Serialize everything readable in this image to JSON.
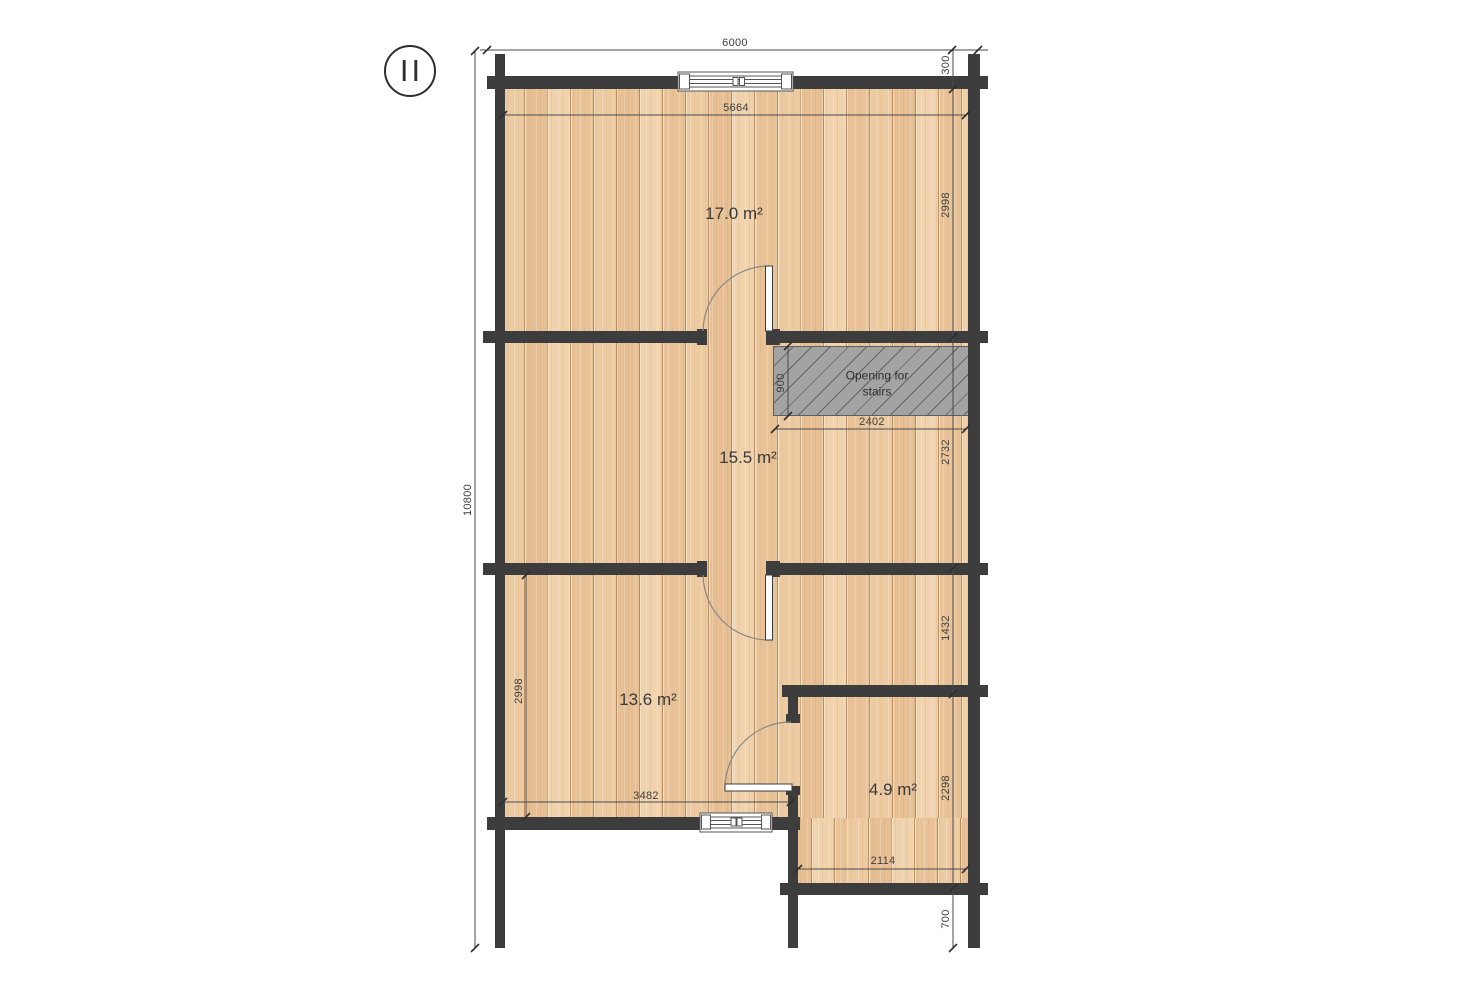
{
  "floor_marker": {
    "label": "II"
  },
  "rooms": {
    "room_17": {
      "area": "17.0 m²"
    },
    "room_15": {
      "area": "15.5 m²"
    },
    "room_13": {
      "area": "13.6 m²"
    },
    "room_4": {
      "area": "4.9 m²"
    }
  },
  "stairs_opening": {
    "line1": "Opening for",
    "line2": "stairs"
  },
  "dimensions": {
    "overall_width": "6000",
    "right_end_offset": "300",
    "top_inner_width": "5664",
    "upper_right_height": "2998",
    "stairs_height": "900",
    "stairs_width": "2402",
    "mid_right_height": "2732",
    "overall_height": "10800",
    "lower_right_height": "1432",
    "lower_left_height": "2998",
    "bottom_inner_width": "3482",
    "small_room_height": "2298",
    "small_room_width": "2114",
    "bottom_right_offset": "700"
  },
  "colors": {
    "wall": "#3d3d3d",
    "floor_plank": "#ecc9a0",
    "stairs_fill": "#a3a3a3",
    "dimension_line": "#4a4a4a",
    "label_text": "#3a3a3a"
  }
}
